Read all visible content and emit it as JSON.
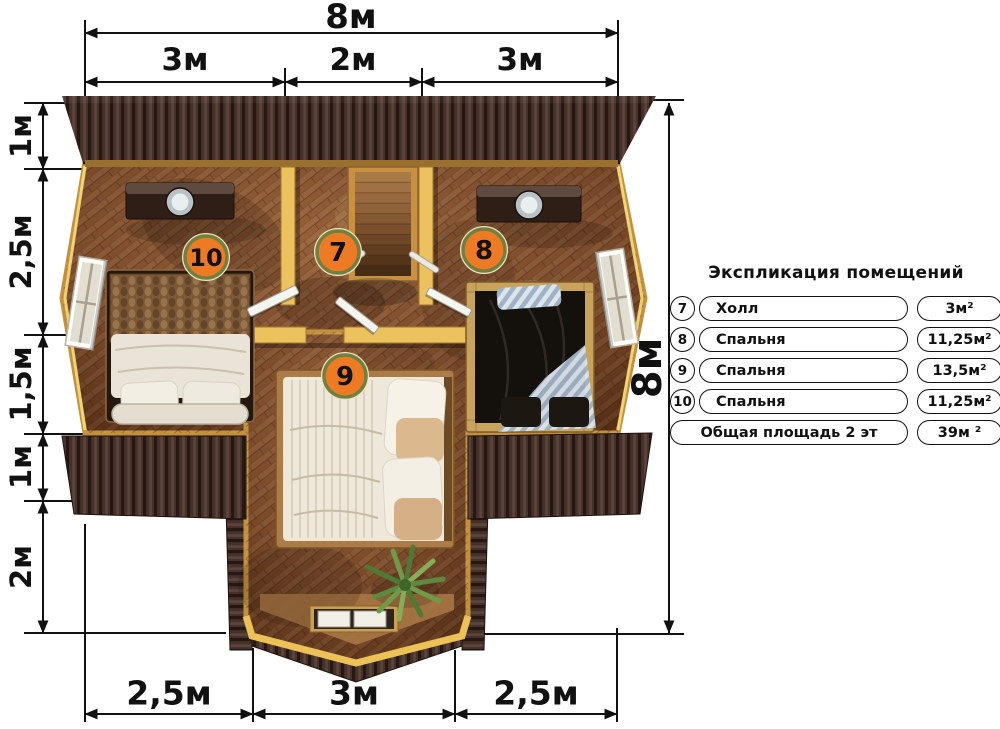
{
  "plan": {
    "badges": [
      {
        "room": "bedroom-left",
        "label": "10"
      },
      {
        "room": "hall",
        "label": "7"
      },
      {
        "room": "bedroom-right",
        "label": "8"
      },
      {
        "room": "bedroom-bottom",
        "label": "9"
      }
    ]
  },
  "dimensions": {
    "top": {
      "total": "8м",
      "segments": [
        "3м",
        "2м",
        "3м"
      ]
    },
    "left": {
      "segments": [
        "1м",
        "2,5м",
        "1,5м",
        "1м",
        "2м"
      ]
    },
    "right": {
      "total": "8м"
    },
    "bottom": {
      "segments": [
        "2,5м",
        "3м",
        "2,5м"
      ]
    }
  },
  "legend": {
    "title": "Экспликация помещений",
    "rows": [
      {
        "number": "7",
        "name": "Холл",
        "area": "3м²"
      },
      {
        "number": "8",
        "name": "Спальня",
        "area": "11,25м²"
      },
      {
        "number": "9",
        "name": "Спальня",
        "area": "13,5м²"
      },
      {
        "number": "10",
        "name": "Спальня",
        "area": "11,25м²"
      }
    ],
    "total": {
      "label": "Общая площадь 2 эт",
      "area": "39м ²"
    }
  },
  "colors": {
    "badge_fill": "#ee7b23",
    "badge_ring": "#6f8140",
    "wall_wood": "#ecc25e",
    "floor_wood": "#7a4a2c",
    "roof_dark": "#3a2721",
    "dimension_line": "#111111"
  }
}
